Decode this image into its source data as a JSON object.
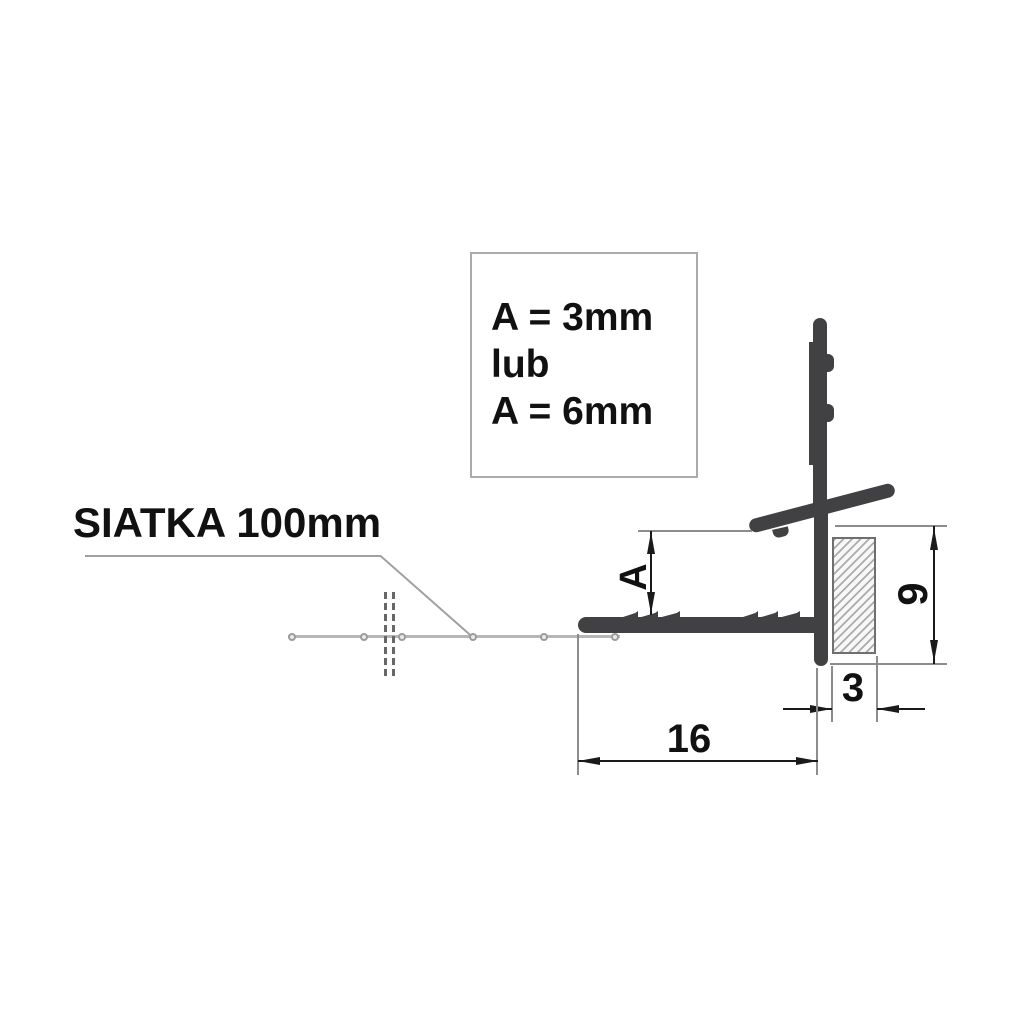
{
  "annotation": {
    "lines": [
      "A = 3mm",
      "lub",
      "A = 6mm"
    ]
  },
  "mesh_label": {
    "text": "SIATKA 100mm"
  },
  "dims": {
    "a": {
      "label": "A"
    },
    "h9": {
      "label": "9"
    },
    "w3": {
      "label": "3"
    },
    "w16": {
      "label": "16"
    }
  },
  "colors": {
    "background": "#ffffff",
    "profile": "#414144",
    "dimension": "#1a1a1a",
    "extension": "#8c8c8c",
    "mesh": "#b6b6b6",
    "mesh_node_ring": "#9c9c9c",
    "leader": "#a0a0a0",
    "break_mark": "#676767",
    "hatch_line": "#ababab",
    "hatch_border": "#6f6f6f",
    "box_border": "#ababab"
  }
}
